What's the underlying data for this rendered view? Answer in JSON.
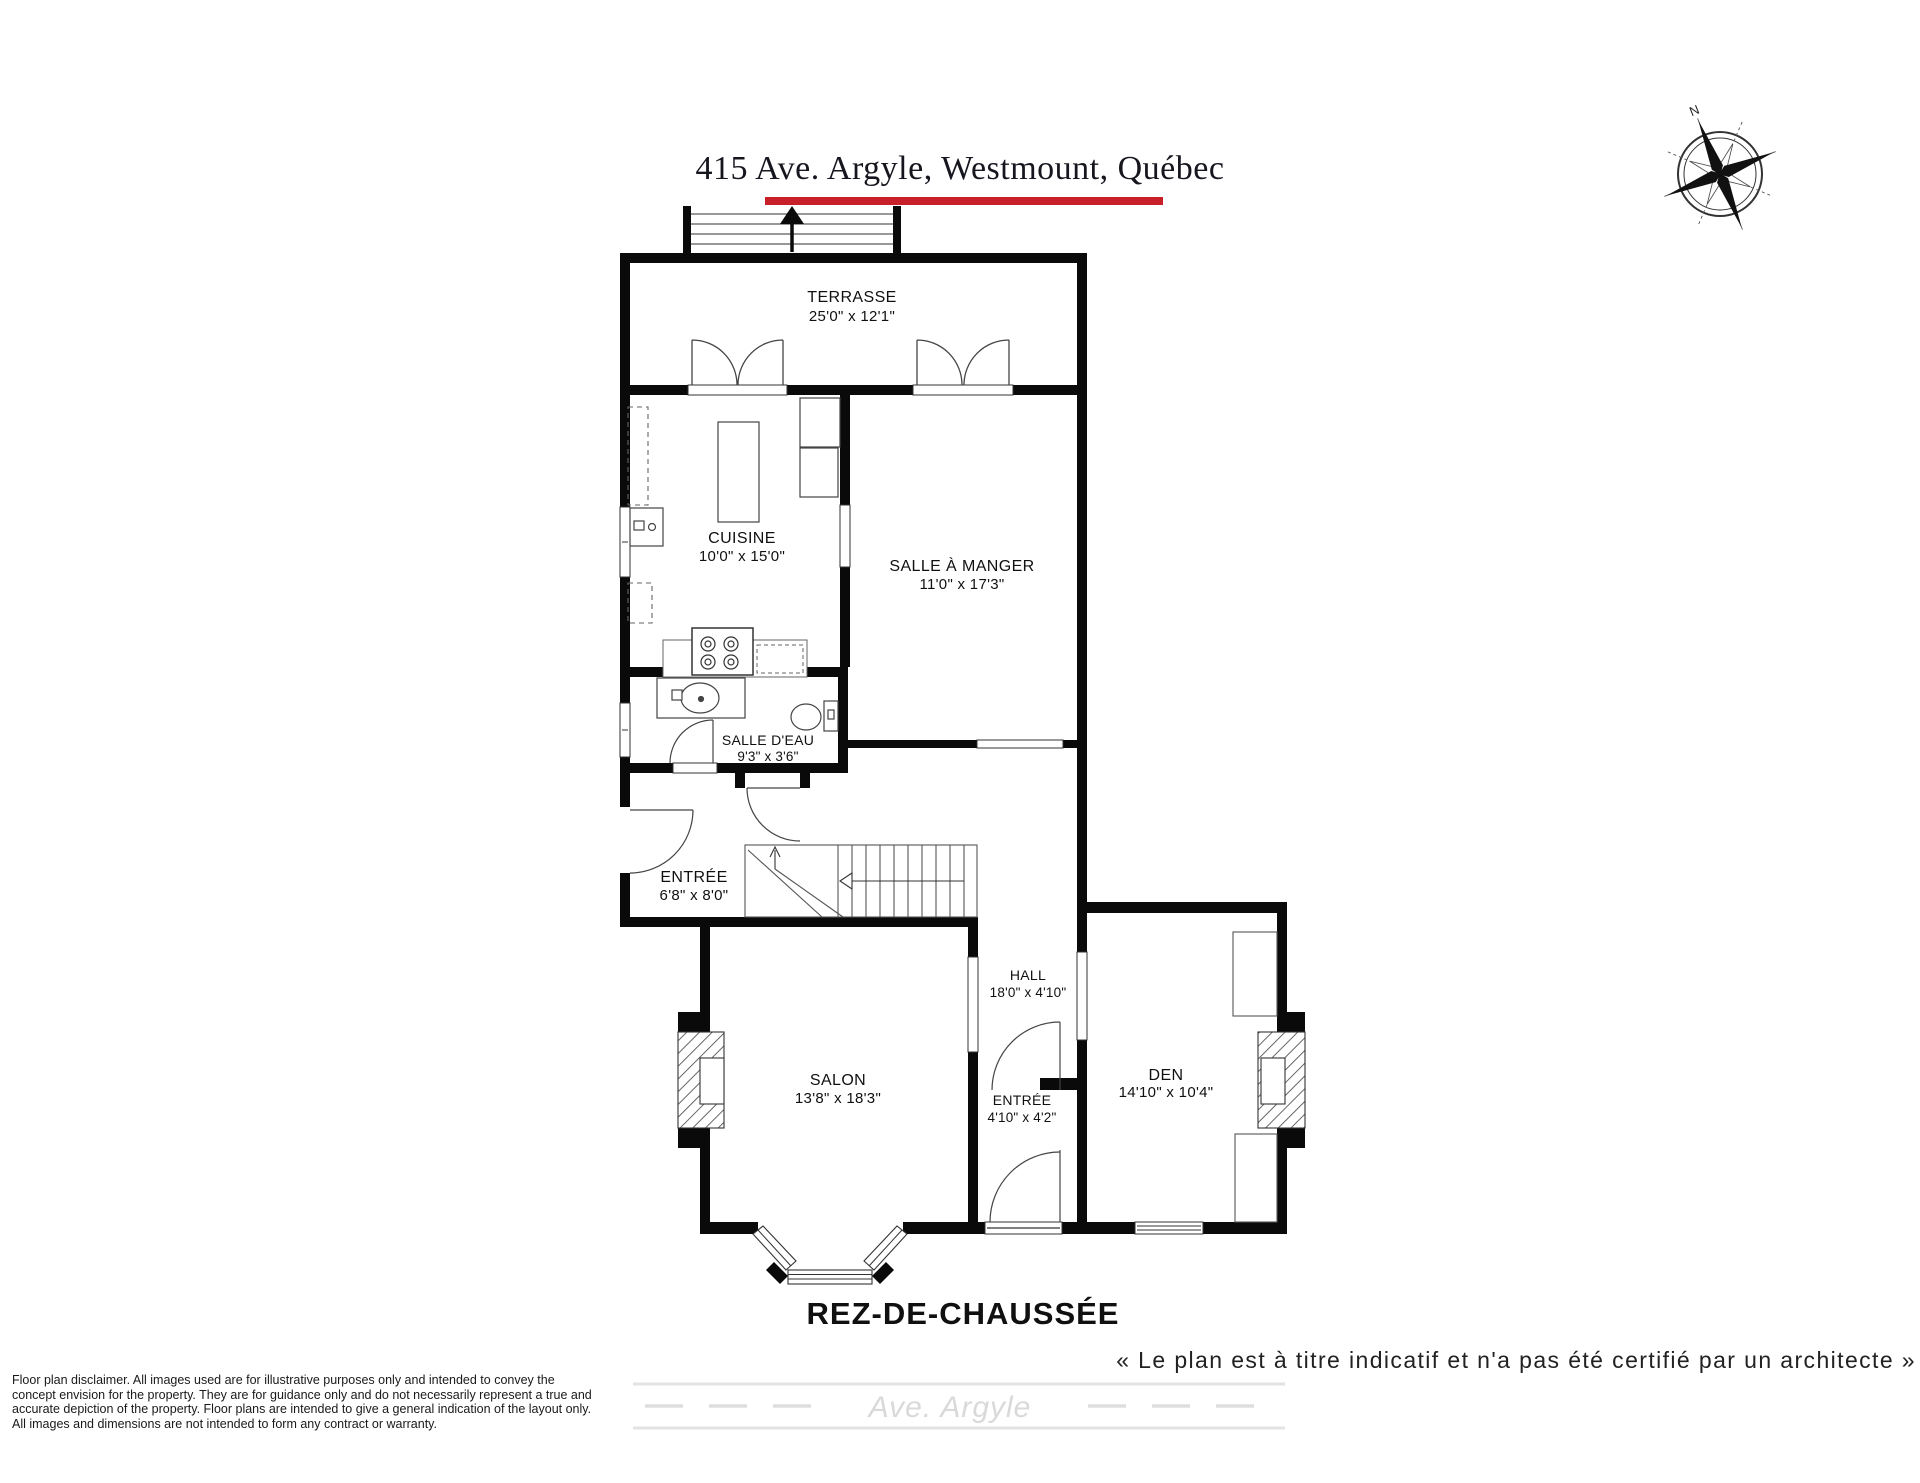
{
  "title": "415 Ave. Argyle, Westmount, Québec",
  "accent_color": "#c8202a",
  "floor_label": "REZ-DE-CHAUSSÉE",
  "quote": "« Le plan est à titre indicatif et n'a pas été certifié par un architecte »",
  "compass": {
    "north_label": "N"
  },
  "street": {
    "label": "Ave. Argyle"
  },
  "rooms": {
    "terrasse": {
      "name": "TERRASSE",
      "dims": "25'0\" x 12'1\""
    },
    "cuisine": {
      "name": "CUISINE",
      "dims": "10'0\" x 15'0\""
    },
    "salle_a_manger": {
      "name": "SALLE À MANGER",
      "dims": "11'0\" x 17'3\""
    },
    "salle_deau": {
      "name": "SALLE D'EAU",
      "dims": "9'3\" x 3'6\""
    },
    "entree": {
      "name": "ENTRÉE",
      "dims": "6'8\" x 8'0\""
    },
    "hall": {
      "name": "HALL",
      "dims": "18'0\" x 4'10\""
    },
    "salon": {
      "name": "SALON",
      "dims": "13'8\" x 18'3\""
    },
    "den": {
      "name": "DEN",
      "dims": "14'10\" x 10'4\""
    },
    "entree_small": {
      "name": "ENTRÉE",
      "dims": "4'10\" x 4'2\""
    }
  },
  "disclaimer": {
    "line1": "Floor plan disclaimer. All images used are for illustrative purposes only and intended to convey the",
    "line2": "concept envision for the property. They are for guidance only and do not necessarily represent a true and",
    "line3": "accurate depiction of the property. Floor plans are intended to give a general indication of the layout only.",
    "line4": "All images and dimensions are not intended to form any contract or warranty."
  }
}
